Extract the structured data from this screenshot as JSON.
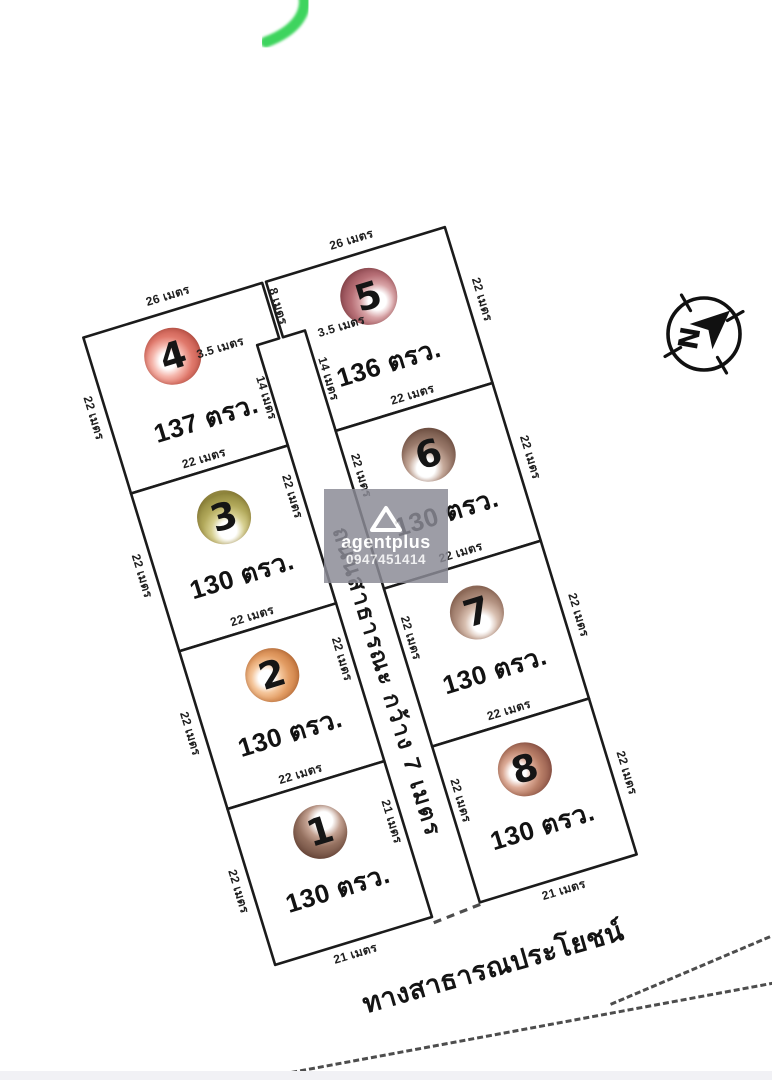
{
  "plan": {
    "plots": [
      {
        "number": "1",
        "area_label": "130 ตรว.",
        "highlight_at": "62% 32%",
        "colors": {
          "light": "#c3a191",
          "mid": "#94705f",
          "dark": "#6f4e40"
        }
      },
      {
        "number": "2",
        "area_label": "130 ตรว.",
        "highlight_at": "38% 52%",
        "colors": {
          "light": "#f4c59a",
          "mid": "#e29c63",
          "dark": "#c87a41"
        }
      },
      {
        "number": "3",
        "area_label": "130 ตรว.",
        "highlight_at": "50% 75%",
        "colors": {
          "light": "#d6cf8f",
          "mid": "#b2a95b",
          "dark": "#8f863c"
        }
      },
      {
        "number": "4",
        "area_label": "137 ตรว.",
        "highlight_at": "40% 55%",
        "colors": {
          "light": "#f5b7ad",
          "mid": "#e0796c",
          "dark": "#c2564a"
        }
      },
      {
        "number": "5",
        "area_label": "136 ตรว.",
        "highlight_at": "62% 62%",
        "colors": {
          "light": "#d8a3a6",
          "mid": "#b76f76",
          "dark": "#8f4a52"
        }
      },
      {
        "number": "6",
        "area_label": "130 ตรว.",
        "highlight_at": "38% 72%",
        "colors": {
          "light": "#c6aa9b",
          "mid": "#99796a",
          "dark": "#745648"
        }
      },
      {
        "number": "7",
        "area_label": "130 ตรว.",
        "highlight_at": "52% 72%",
        "colors": {
          "light": "#d8bfb0",
          "mid": "#b29180",
          "dark": "#8f6c5a"
        }
      },
      {
        "number": "8",
        "area_label": "130 ตรว.",
        "highlight_at": "36% 52%",
        "colors": {
          "light": "#dcab97",
          "mid": "#b87e67",
          "dark": "#91584a"
        }
      }
    ],
    "road_label": "ถนนสาธารณะ กว้าง 7 เมตร",
    "public_way_label": "ทางสาธารณประโยชน์",
    "dims": [
      "26 เมตร",
      "26 เมตร",
      "8 เมตร",
      "3.5 เมตร",
      "3.5 เมตร",
      "14 เมตร",
      "14 เมตร",
      "22 เมตร",
      "22 เมตร",
      "22 เมตร",
      "22 เมตร",
      "22 เมตร",
      "22 เมตร",
      "22 เมตร",
      "21 เมตร",
      "22 เมตร",
      "22 เมตร",
      "21 เมตร",
      "22 เมตร",
      "22 เมตร",
      "22 เมตร",
      "22 เมตร",
      "22 เมตร",
      "22 เมตร",
      "22 เมตร",
      "22 เมตร",
      "22 เมตร",
      "22 เมตร",
      "21 เมตร"
    ]
  },
  "watermark": {
    "brand": "agentplus",
    "phone": "0947451414",
    "bg": "#8b8b96"
  },
  "compass": {
    "north_letter": "N"
  },
  "colors": {
    "line": "#1b1b1b",
    "dash": "#4d4d4d",
    "green_mark": "#2bd04d",
    "paper": "#ffffff",
    "bottom_strip": "#f1f1f5"
  }
}
